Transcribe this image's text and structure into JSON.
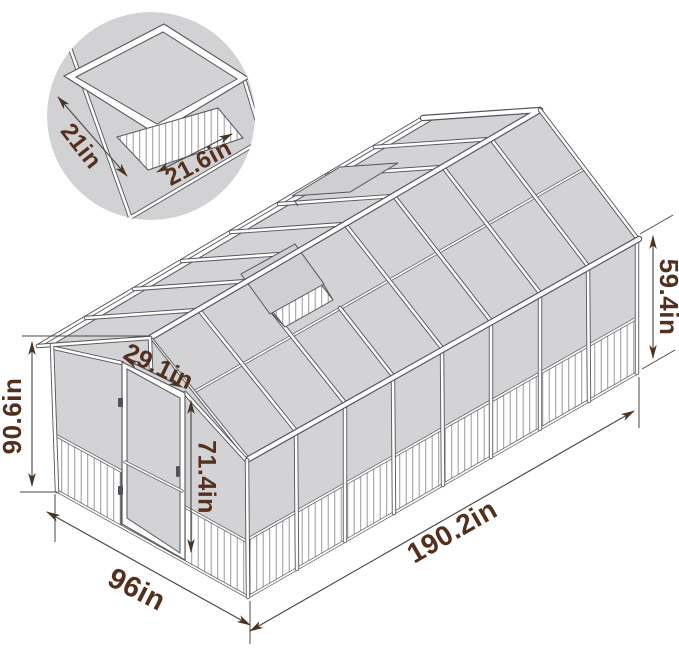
{
  "figure": {
    "type": "dimension-diagram",
    "subject": "greenhouse",
    "unit": "in"
  },
  "colors": {
    "panel": "#d3d3d5",
    "outline": "#55555a",
    "label_text": "#53301d",
    "dimension_line": "#4c4844",
    "background": "#ffffff"
  },
  "dimensions": {
    "total_height": "90.6in",
    "wall_height": "59.4in",
    "base_length": "190.2in",
    "base_width": "96in",
    "door_width": "29.1in",
    "door_height": "71.4in",
    "vent_side_a": "21in",
    "vent_side_b": "21.6in"
  }
}
